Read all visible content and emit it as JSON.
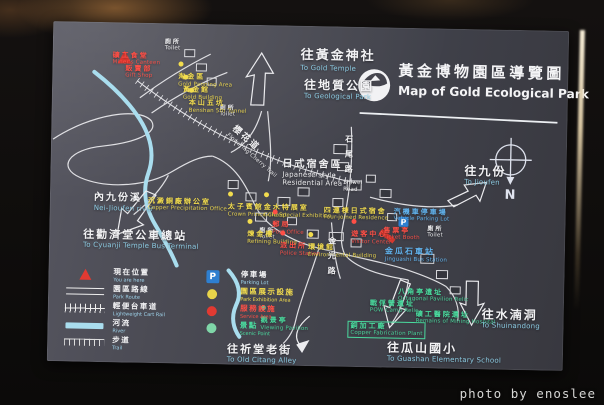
{
  "photo": {
    "watermark": "photo by enoslee"
  },
  "sign": {
    "title": {
      "cn": "黃金博物園區導覽圖",
      "en": "Map of Gold Ecological Park"
    },
    "compass_label": "N",
    "parking_symbol": "P",
    "colors": {
      "panel": "#45454e",
      "river": "#a9ddee",
      "road": "#ececef",
      "exhibition": "#f2dc4e",
      "service": "#ff4f46",
      "scenic": "#4ada9e",
      "parking": "#62b6f2",
      "direction_en": "#8fd0e8"
    },
    "labels": [
      {
        "id": "to-gold-temple",
        "cn": "往黃金神社",
        "en": "To Gold Temple",
        "color": "white",
        "x": 248,
        "y": 22,
        "cs": 13,
        "big": 1,
        "en_color": "#8fd0e8"
      },
      {
        "id": "to-geological-park",
        "cn": "往地質公園",
        "en": "To Geological Park",
        "color": "white",
        "x": 252,
        "y": 52,
        "cs": 12,
        "big": 1,
        "en_color": "#8fd0e8"
      },
      {
        "id": "toilet-1",
        "cn": "廁所",
        "en": "Toilet",
        "color": "white",
        "x": 112,
        "y": 15,
        "cs": 6
      },
      {
        "id": "toilet-2",
        "cn": "廁所",
        "en": "Toilet",
        "color": "white",
        "x": 168,
        "y": 80,
        "cs": 6
      },
      {
        "id": "toilet-3",
        "cn": "廁所",
        "en": "Toilet",
        "color": "white",
        "x": 378,
        "y": 197,
        "cs": 6
      },
      {
        "id": "toilet-4",
        "cn": "廁所",
        "en": "Toilet",
        "color": "white",
        "x": 210,
        "y": 202,
        "cs": 6
      },
      {
        "id": "miners-canteen",
        "cn": "礦工食堂",
        "en": "Miner's Canteen",
        "color": "red",
        "x": 60,
        "y": 29,
        "cs": 7
      },
      {
        "id": "gift-shop",
        "cn": "販賣部",
        "en": "Gift Shop",
        "color": "red",
        "x": 73,
        "y": 42,
        "cs": 7
      },
      {
        "id": "gold-panning-area",
        "cn": "淘金區",
        "en": "Gold Panning Area",
        "color": "yellow",
        "x": 126,
        "y": 30,
        "cs": 7,
        "dot": "yellow"
      },
      {
        "id": "gold-building",
        "cn": "黃金館",
        "en": "Gold Building",
        "color": "yellow",
        "x": 131,
        "y": 43,
        "cs": 7,
        "dot": "yellow"
      },
      {
        "id": "benshan-5th-tunnel",
        "cn": "本山五坑",
        "en": "Benshan 5th Tunnel",
        "color": "yellow",
        "x": 137,
        "y": 56,
        "cs": 7,
        "dot": "yellow"
      },
      {
        "id": "nei-jioufen-river",
        "cn": "內九份溪",
        "en": "Nei-Jioufen river",
        "color": "white",
        "x": 44,
        "y": 170,
        "cs": 10,
        "big": 1,
        "en_color": "#8fd0e8"
      },
      {
        "id": "copper-precipitation-office",
        "cn": "沉澱銅廠辦公室",
        "en": "Copper Precipitation Office",
        "color": "yellow",
        "x": 98,
        "y": 174,
        "cs": 7
      },
      {
        "id": "to-cyuanji-bus-terminal",
        "cn": "往勸濟堂公車總站",
        "en": "To Cyuanji Temple Bus Terminal",
        "color": "white",
        "x": 34,
        "y": 206,
        "cs": 11,
        "big": 1,
        "en_color": "#8fd0e8"
      },
      {
        "id": "cherry-trail",
        "cn": "櫻花道",
        "en": "Flowering Cherry Trail",
        "color": "white",
        "x": 172,
        "y": 118,
        "cs": 9,
        "rot": 40
      },
      {
        "id": "japanese-residential-area",
        "cn": "日式宿舍區",
        "en": "Japanese style\nResidential Area",
        "color": "white",
        "x": 232,
        "y": 133,
        "cs": 10,
        "big": 1
      },
      {
        "id": "shiwei-road",
        "cn": "石尾路",
        "en": "Shiwei\nRoad",
        "color": "white",
        "x": 293,
        "y": 108,
        "cs": 8,
        "vertical": 1
      },
      {
        "id": "to-jioufen",
        "cn": "往九份",
        "en": "To Jioufen",
        "color": "white",
        "x": 414,
        "y": 135,
        "cs": 12,
        "big": 1,
        "en_color": "#8fd0e8"
      },
      {
        "id": "crown-prince-chalet",
        "cn": "太子賓館",
        "en": "Crown Prince Chalet",
        "color": "yellow",
        "x": 178,
        "y": 159,
        "cs": 7,
        "dot": "yellow"
      },
      {
        "id": "gold-special-exhibition",
        "cn": "金水特展室",
        "en": "Gold Special Exhibition",
        "color": "yellow",
        "x": 214,
        "y": 159,
        "cs": 7,
        "dot": "yellow"
      },
      {
        "id": "refining-building",
        "cn": "煉金樓",
        "en": "Refining Building",
        "color": "yellow",
        "x": 198,
        "y": 186,
        "cs": 7,
        "dot": "yellow"
      },
      {
        "id": "post-office",
        "cn": "郵局",
        "en": "Post Office",
        "color": "red",
        "x": 223,
        "y": 176,
        "cs": 7,
        "dot": "red"
      },
      {
        "id": "police-station",
        "cn": "派出所",
        "en": "Police Station",
        "color": "red",
        "x": 231,
        "y": 197,
        "cs": 7,
        "dot": "red"
      },
      {
        "id": "environmental-building",
        "cn": "環境館",
        "en": "Environmental Building",
        "color": "yellow",
        "x": 259,
        "y": 198,
        "cs": 7,
        "dot": "yellow"
      },
      {
        "id": "four-joined-residence",
        "cn": "四連棟日式宿舍",
        "en": "Four-joined Residence",
        "color": "yellow",
        "x": 274,
        "y": 180,
        "cs": 7
      },
      {
        "id": "visitor-center",
        "cn": "遊客中心",
        "en": "Visitor Center",
        "color": "red",
        "x": 302,
        "y": 184,
        "cs": 7,
        "dot": "red"
      },
      {
        "id": "vehicle-parking-lot",
        "cn": "汽機車停車場",
        "en": "Vehicle Parking Lot",
        "color": "blue",
        "x": 344,
        "y": 180,
        "cs": 7
      },
      {
        "id": "ticket-booth",
        "cn": "售票亭",
        "en": "Ticket Booth",
        "color": "red",
        "x": 334,
        "y": 199,
        "cs": 7
      },
      {
        "id": "jinguashi-bus-station",
        "cn": "金瓜石車站",
        "en": "Jinguashi Bus Station",
        "color": "blue",
        "x": 336,
        "y": 219,
        "cs": 8
      },
      {
        "id": "jinguang-road",
        "cn": "金光路",
        "en": "",
        "color": "white",
        "x": 278,
        "y": 210,
        "cs": 8,
        "vertical": 1
      },
      {
        "id": "to-old-citang-alley",
        "cn": "往祈堂老街",
        "en": "To Old Citang Alley",
        "color": "white",
        "x": 180,
        "y": 318,
        "cs": 11,
        "big": 1,
        "en_color": "#8fd0e8"
      },
      {
        "id": "copper-fabrication-plant",
        "cn": "銅加工廠",
        "en": "Copper Fabrication Plant",
        "color": "green",
        "x": 300,
        "y": 294,
        "cs": 7,
        "box": 1
      },
      {
        "id": "octagonal-pavilion-relic",
        "cn": "八角亭遺址",
        "en": "Octagonal Pavilion Relic",
        "color": "green",
        "x": 350,
        "y": 260,
        "cs": 7
      },
      {
        "id": "pow-camp-relic",
        "cn": "戰俘營遺址",
        "en": "POW Camp Relic",
        "color": "green",
        "x": 322,
        "y": 272,
        "cs": 7
      },
      {
        "id": "mining-hospital-relic",
        "cn": "礦工醫院遺址",
        "en": "Remains of Mining Hospital",
        "color": "green",
        "x": 368,
        "y": 282,
        "cs": 7
      },
      {
        "id": "viewing-pavilion",
        "cn": "觀景亭",
        "en": "Viewing Pavilion",
        "color": "green",
        "x": 213,
        "y": 272,
        "cs": 7,
        "dot": "green"
      },
      {
        "id": "to-shuinandong",
        "cn": "往水湳洞",
        "en": "To Shuinandong",
        "color": "white",
        "x": 434,
        "y": 278,
        "cs": 12,
        "big": 1,
        "en_color": "#8fd0e8"
      },
      {
        "id": "to-guashan-elementary",
        "cn": "往瓜山國小",
        "en": "To Guashan Elementary School",
        "color": "white",
        "x": 340,
        "y": 313,
        "cs": 12,
        "big": 1,
        "en_color": "#8fd0e8"
      }
    ],
    "legend": {
      "left": [
        {
          "icon": "triangle",
          "cn": "現在位置",
          "en": "You are here",
          "tone": ""
        },
        {
          "icon": "route",
          "cn": "園區路線",
          "en": "Park Route",
          "tone": ""
        },
        {
          "icon": "rail",
          "cn": "輕便台車道",
          "en": "Lightweight Cart Rail",
          "tone": ""
        },
        {
          "icon": "river",
          "cn": "河流",
          "en": "River",
          "tone": ""
        },
        {
          "icon": "trail",
          "cn": "步道",
          "en": "Trail",
          "tone": ""
        }
      ],
      "right": [
        {
          "icon": "parking",
          "cn": "停車場",
          "en": "Parking Lot",
          "tone": ""
        },
        {
          "icon": "dot-y",
          "cn": "園區展示設施",
          "en": "Park Exhibition Area",
          "tone": "t-yellow"
        },
        {
          "icon": "dot-r",
          "cn": "服務設施",
          "en": "Service Area",
          "tone": "t-red"
        },
        {
          "icon": "dot-g",
          "cn": "景點",
          "en": "Scenic Point",
          "tone": "t-green"
        }
      ]
    }
  }
}
